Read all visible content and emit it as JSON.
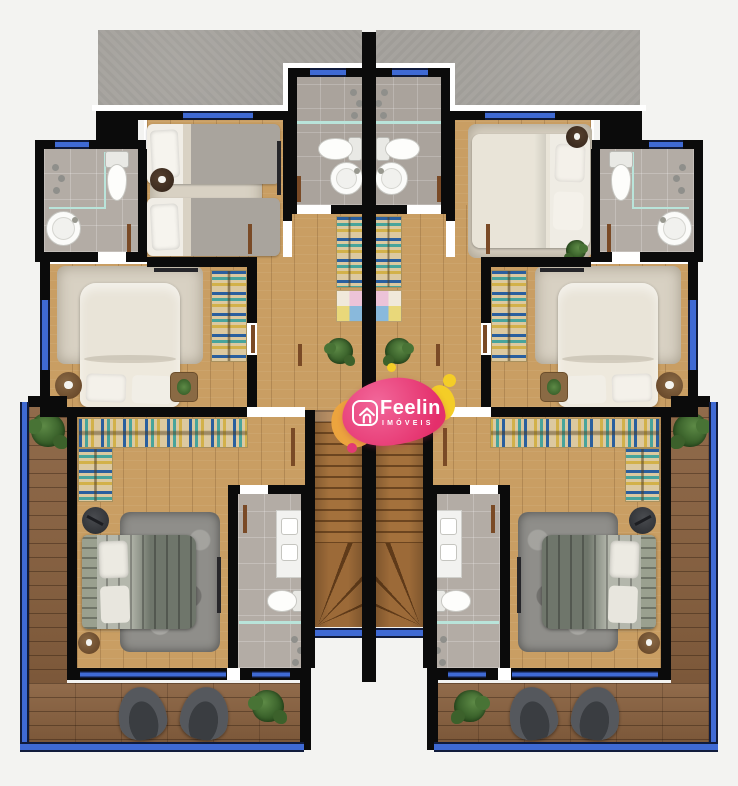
{
  "page": {
    "background": "#f3f3f1",
    "width": 738,
    "height": 786
  },
  "logo": {
    "brand": "Feelin",
    "subtitle": "IMÓVEIS",
    "icon": "house-icon",
    "colors": {
      "pink": "#e42f6b",
      "orange": "#eca43e",
      "yellow": "#f4cd27",
      "text": "#ffffff"
    }
  },
  "palette": {
    "bg": "#f3f3f1",
    "wall": "#0b0b0b",
    "wood-floor": "#c99e63",
    "deck-wood": "#8a6240",
    "tile": "#b3aca5",
    "slab-concrete": "#a6a39e",
    "window-blue": "#3f6ad4",
    "window-frame": "#101b3c",
    "shower-glass": "#b9e4da",
    "stairs-wood": "#a4713c",
    "bed-cream": "#e9e4d8",
    "bed-dark": "#6f766b",
    "rug-gray": "#8f8e8a",
    "shelf-tan": "#dcc9a0",
    "chair-gray": "#55585d",
    "plant-green": "#2f5522",
    "logo-pink": "#e42f6b",
    "logo-orange": "#eca43e",
    "logo-yellow": "#f4cd27"
  },
  "floorplan": {
    "kind": "duplex-upper-floor-plan",
    "units": [
      {
        "id": "unit-left",
        "mirrored": false
      },
      {
        "id": "unit-right",
        "mirrored": true
      }
    ],
    "features_per_unit": [
      "top-bathroom",
      "twin-bedroom",
      "ensuite-bathroom",
      "middle-double-bedroom",
      "hallway-shelves",
      "master-bedroom",
      "master-bathroom",
      "staircase",
      "terrace-deck",
      "armchairs",
      "plants"
    ]
  }
}
